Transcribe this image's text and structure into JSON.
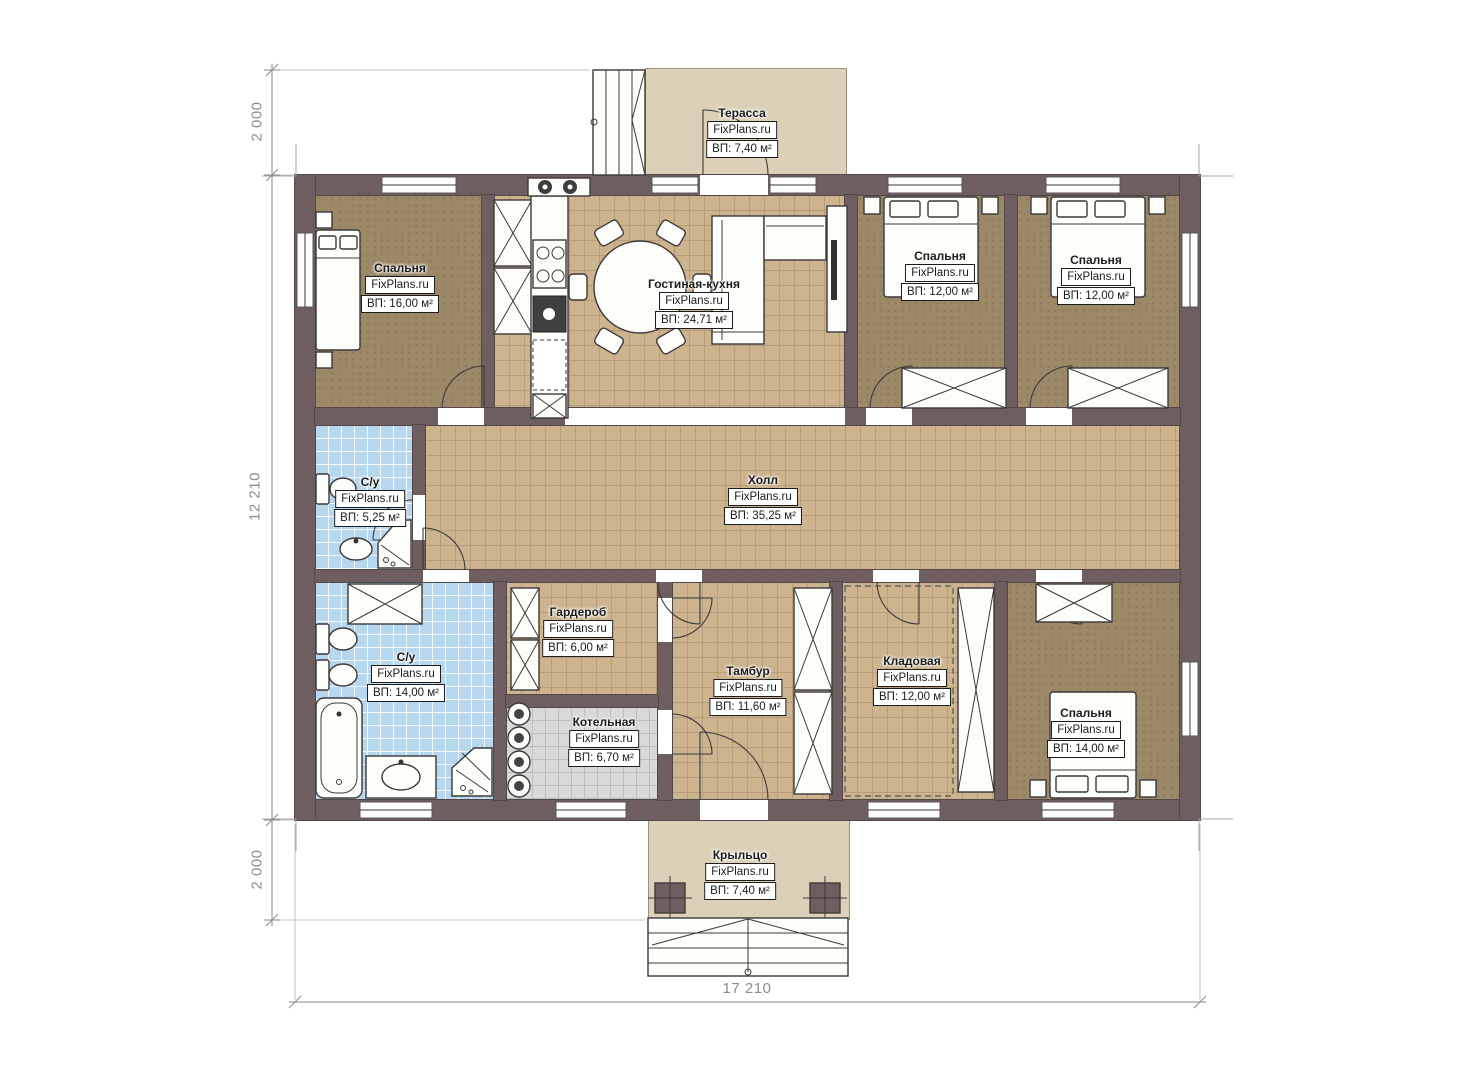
{
  "brand": "FixPlans.ru",
  "rooms": {
    "terrace": {
      "name": "Терасса",
      "area": "ВП: 7,40 м²"
    },
    "bedroom1": {
      "name": "Спальня",
      "area": "ВП: 16,00 м²"
    },
    "kitchen": {
      "name": "Гостиная-кухня",
      "area": "ВП: 24,71 м²"
    },
    "bedroom2": {
      "name": "Спальня",
      "area": "ВП: 12,00 м²"
    },
    "bedroom3": {
      "name": "Спальня",
      "area": "ВП: 12,00 м²"
    },
    "bathroom1": {
      "name": "С/у",
      "area": "ВП: 5,25 м²"
    },
    "hall": {
      "name": "Холл",
      "area": "ВП: 35,25 м²"
    },
    "bathroom2": {
      "name": "С/у",
      "area": "ВП: 14,00 м²"
    },
    "wardrobe": {
      "name": "Гардероб",
      "area": "ВП: 6,00 м²"
    },
    "vestibule": {
      "name": "Тамбур",
      "area": "ВП: 11,60 м²"
    },
    "storage": {
      "name": "Кладовая",
      "area": "ВП: 12,00 м²"
    },
    "boiler": {
      "name": "Котельная",
      "area": "ВП: 6,70 м²"
    },
    "bedroom4": {
      "name": "Спальня",
      "area": "ВП: 14,00 м²"
    },
    "porch": {
      "name": "Крыльцо",
      "area": "ВП: 7,40 м²"
    }
  },
  "dimensions": {
    "left_top": "2 000",
    "left_middle": "12 210",
    "left_bottom": "2 000",
    "bottom_width": "17 210"
  },
  "colors": {
    "wall": "#6f5e5f",
    "floor_brown": "#9c8968",
    "tile_tan": "#cdb38e",
    "tile_blue": "#b6d7ee",
    "tile_gray": "#d9d9d9",
    "deck_beige": "#dcd1b8"
  }
}
